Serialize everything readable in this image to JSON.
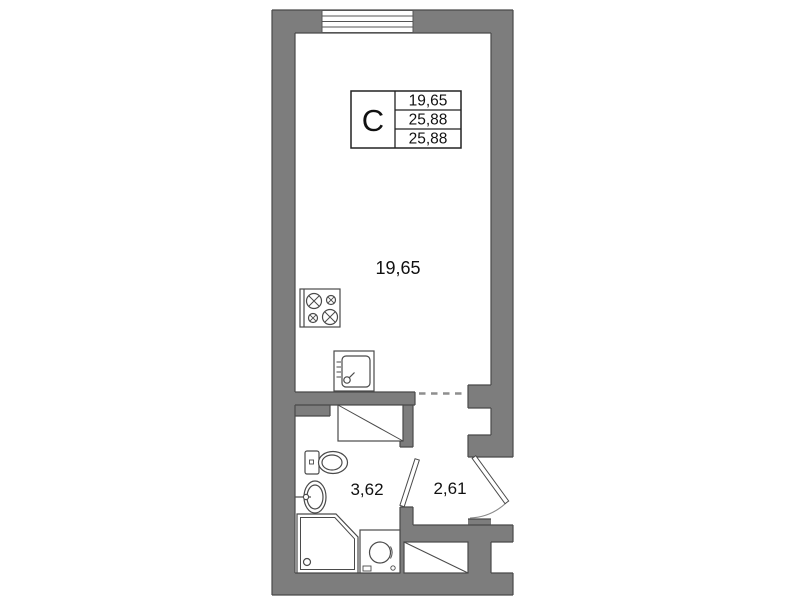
{
  "info_table": {
    "unit_type": "C",
    "values": [
      "19,65",
      "25,88",
      "25,88"
    ]
  },
  "rooms": [
    {
      "name": "main-room",
      "area": "19,65"
    },
    {
      "name": "bathroom",
      "area": "3,62"
    },
    {
      "name": "hallway",
      "area": "2,61"
    }
  ],
  "fixtures": [
    "window",
    "stove",
    "kitchen-sink",
    "wardrobe",
    "toilet",
    "washbasin",
    "shower",
    "washing-machine",
    "closet",
    "entrance-door",
    "bathroom-door",
    "opening-dash-line"
  ],
  "colors": {
    "wall": "#7d7d7d",
    "wall_edge": "#4a4a4a",
    "fixture_line": "#4a4a4a",
    "text": "#111111",
    "dash": "#8e8e8e",
    "background": "#ffffff"
  }
}
